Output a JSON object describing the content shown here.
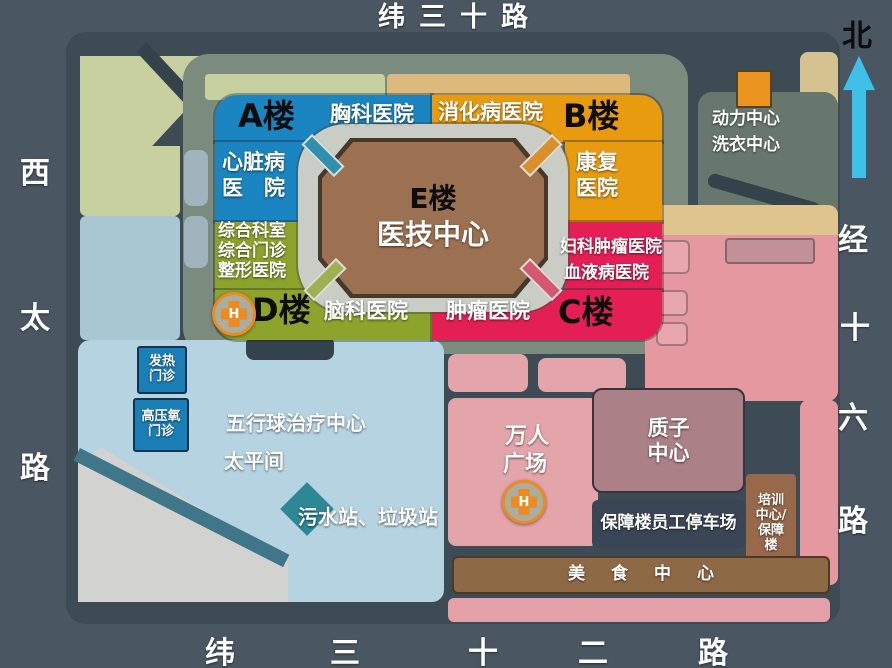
{
  "map_title": {
    "top_road": "纬三十路",
    "north": "北"
  },
  "roads": {
    "left": [
      "西",
      "太",
      "路"
    ],
    "right": [
      "经",
      "十",
      "六",
      "路"
    ],
    "bottom": [
      "纬",
      "三",
      "十",
      "二",
      "路"
    ]
  },
  "complex": {
    "building_a": "A楼",
    "building_b": "B楼",
    "building_c": "C楼",
    "building_d": "D楼",
    "building_e": "E楼",
    "medtech_center": "医技中心",
    "chest_hospital": "胸科医院",
    "digestive_hospital": "消化病医院",
    "heart_hospital": [
      "心脏病",
      "医　院"
    ],
    "rehab_hospital": [
      "康复",
      "医院"
    ],
    "general_depts": [
      "综合科室",
      "综合门诊",
      "整形医院"
    ],
    "gyn_oncology_hospital": "妇科肿瘤医院",
    "hematology_hospital": "血液病医院",
    "brain_hospital": "脑科医院",
    "oncology_hospital": "肿瘤医院"
  },
  "facilities": {
    "power_center": [
      "动力中心",
      "洗衣中心"
    ],
    "fever_clinic": [
      "发热",
      "门诊"
    ],
    "hyperbaric_clinic": [
      "高压氧",
      "门诊"
    ],
    "five_ball_center": "五行球治疗中心",
    "morgue": "太平间",
    "sewage_station": "污水站、垃圾站",
    "grand_square": [
      "万人",
      "广场"
    ],
    "proton_center": [
      "质子",
      "中心"
    ],
    "staff_parking": "保障楼员工停车场",
    "training_center": [
      "培训",
      "中心/",
      "保障",
      "楼"
    ],
    "food_center": "美食中心",
    "helipad_letter": "H"
  },
  "colors": {
    "building_a_blue": "#1a85c0",
    "building_b_orange": "#e99b10",
    "building_d_green": "#8ca32c",
    "building_c_crimson": "#e41f55",
    "building_e_brown": "#9b7151",
    "pink_zone": "#e5989f",
    "lightblue_zone": "#b6d3e1",
    "khaki_zone": "#c9d0a0",
    "north_arrow_cyan": "#3fc0e8",
    "helipad_orange": "#ee8b1c"
  }
}
